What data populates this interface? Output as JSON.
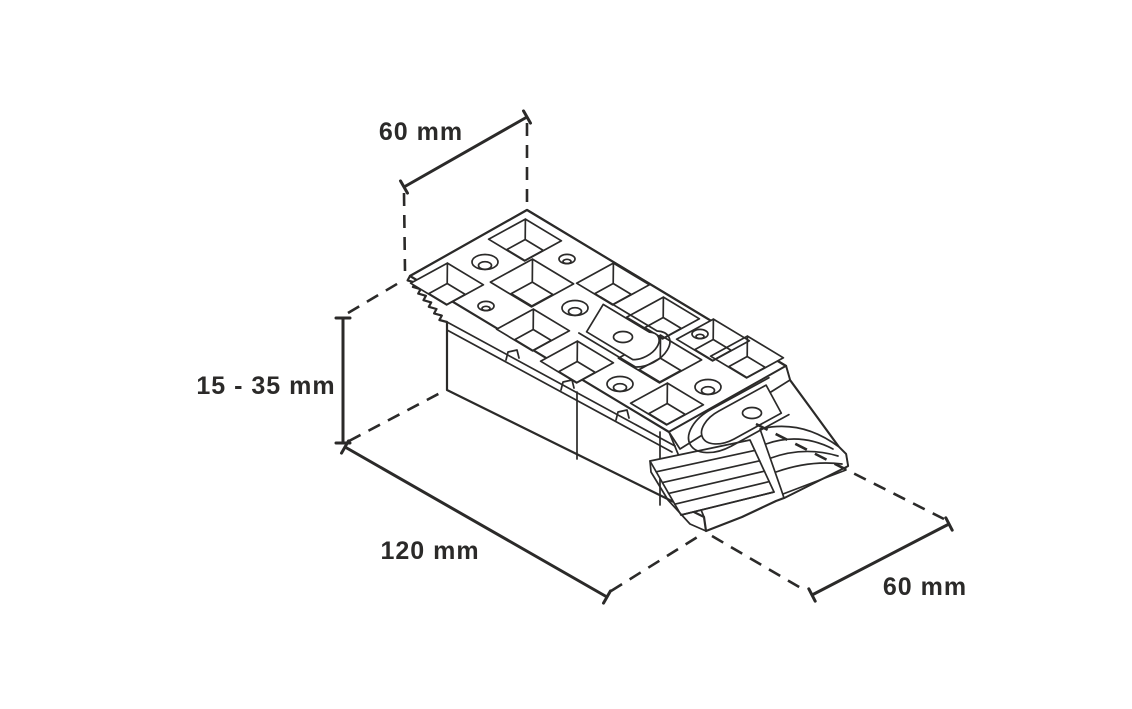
{
  "diagram": {
    "dimension_labels": {
      "top_width": "60 mm",
      "height_range": "15 - 35 mm",
      "length": "120 mm",
      "bottom_width": "60 mm"
    },
    "colors": {
      "line": "#2b2a29",
      "background": "#ffffff"
    }
  }
}
